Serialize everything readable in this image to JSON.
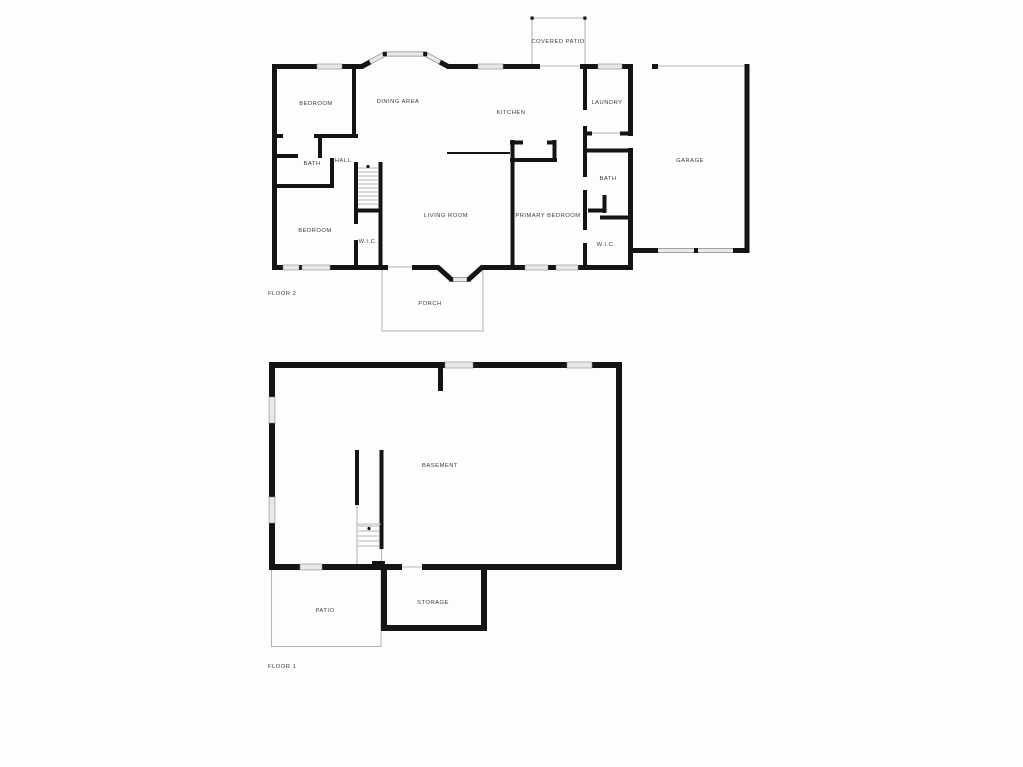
{
  "colors": {
    "background": "#fdfdfd",
    "wall": "#141414",
    "window_fill": "#e8e8e8",
    "window_edge": "#8a8a8a",
    "outline_thin": "#b5b5b5",
    "label": "#3c3c3c"
  },
  "floor2": {
    "floor_label": "FLOOR 2",
    "rooms": [
      {
        "name": "BEDROOM"
      },
      {
        "name": "DINING AREA"
      },
      {
        "name": "KITCHEN"
      },
      {
        "name": "LAUNDRY"
      },
      {
        "name": "COVERED PATIO"
      },
      {
        "name": "GARAGE"
      },
      {
        "name": "BATH"
      },
      {
        "name": "HALL"
      },
      {
        "name": "BEDROOM"
      },
      {
        "name": "W.I.C."
      },
      {
        "name": "LIVING ROOM"
      },
      {
        "name": "PRIMARY BEDROOM"
      },
      {
        "name": "BATH"
      },
      {
        "name": "W.I.C."
      },
      {
        "name": "PORCH"
      }
    ]
  },
  "floor1": {
    "floor_label": "FLOOR 1",
    "rooms": [
      {
        "name": "BASEMENT"
      },
      {
        "name": "STORAGE"
      },
      {
        "name": "PATIO"
      }
    ]
  }
}
